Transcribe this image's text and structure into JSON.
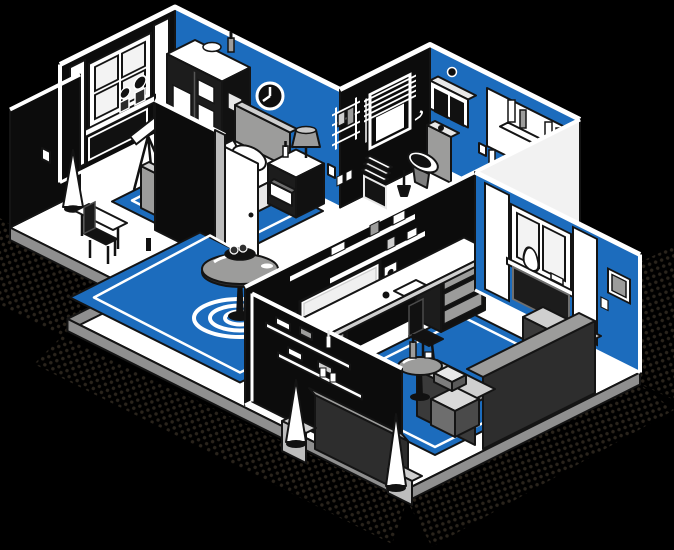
{
  "title": "Isometric apartment cutaway illustration",
  "palette": {
    "c-bg": "#000000",
    "c-blue": "#1c6cbd",
    "c-wall": "#0c0c0c",
    "c-floor": "#ffffff",
    "c-gray": "#9c9c9b",
    "c-gray-d": "#6e6e6e",
    "c-gray-l": "#cfcfcf",
    "c-ink": "#141414",
    "c-dots": "#2a241c",
    "c-plinth": "#8f8f8f",
    "c-sofa": "#2d2d2d"
  },
  "scene": {
    "style": "isometric cutaway, black background, halftone dot shadow",
    "rooms": [
      {
        "name": "bedroom",
        "walls": [
          "black wall with window, curtains, plants, radiator",
          "blue wall with clock"
        ],
        "furniture": [
          "wardrobe",
          "bed with pillow and book",
          "nightstand with lamp and open drawer",
          "telescope",
          "blue rug",
          "cone floor lamp",
          "side chair",
          "small table",
          "wall light switch"
        ]
      },
      {
        "name": "bathroom",
        "walls": [
          "black wall with blinds window, towel rack, hook, switches",
          "blue wall with mirror, cabinet, shelf"
        ],
        "furniture": [
          "toilet",
          "toilet brush",
          "wash basin with faucet and bottles",
          "bathtub",
          "trash bin with folded towels",
          "cone vase"
        ]
      },
      {
        "name": "hall",
        "furniture": [
          "blue round rug with white rings",
          "pedestal table with fruit bowl",
          "shelf wall with objects and switches",
          "open white door",
          "sofa seen from behind",
          "two cone floor lamps",
          "round side table with bottle"
        ]
      },
      {
        "name": "living-room",
        "walls": [
          "black wall with shelves, TV, speakers, wall hook",
          "blue wall with curtained window, vase, picture frame, switch"
        ],
        "furniture": [
          "desk with drawer cabinets",
          "desk chair",
          "blue rug",
          "sofa seen from behind",
          "stacked boxes",
          "window cabinet"
        ]
      }
    ]
  }
}
